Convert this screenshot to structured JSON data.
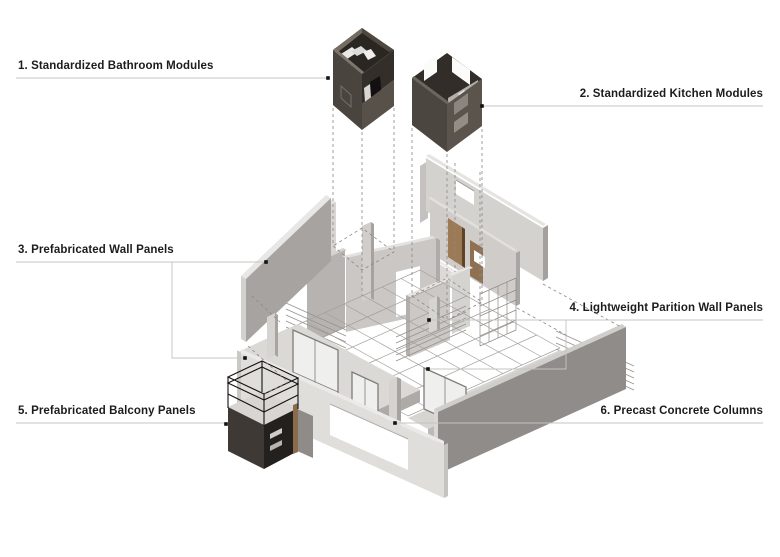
{
  "page": {
    "width": 780,
    "height": 557,
    "background": "#ffffff"
  },
  "diagram": {
    "kind": "exploded axonometric assembly diagram",
    "subject": "prefabricated modular housing components"
  },
  "labels": [
    {
      "id": "1",
      "text": "1. Standardized Bathroom Modules",
      "side": "left",
      "x": 18,
      "y": 60,
      "leader": {
        "lines": [
          [
            [
              16,
              78
            ],
            [
              328,
              78
            ]
          ]
        ],
        "dots": [
          [
            328,
            78
          ]
        ]
      }
    },
    {
      "id": "2",
      "text": "2. Standardized Kitchen Modules",
      "side": "right",
      "right": 17,
      "y": 88,
      "leader": {
        "lines": [
          [
            [
              482,
              106
            ],
            [
              763,
              106
            ]
          ]
        ],
        "dots": [
          [
            482,
            106
          ]
        ]
      }
    },
    {
      "id": "3",
      "text": "3. Prefabricated Wall Panels",
      "side": "left",
      "x": 18,
      "y": 244,
      "leader": {
        "lines": [
          [
            [
              16,
              262
            ],
            [
              266,
              262
            ]
          ],
          [
            [
              172,
              262
            ],
            [
              172,
              358
            ],
            [
              245,
              358
            ]
          ]
        ],
        "dots": [
          [
            266,
            262
          ],
          [
            245,
            358
          ]
        ]
      }
    },
    {
      "id": "4",
      "text": "4. Lightweight Parition Wall Panels",
      "side": "right",
      "right": 17,
      "y": 302,
      "leader": {
        "lines": [
          [
            [
              429,
              320
            ],
            [
              763,
              320
            ]
          ],
          [
            [
              566,
              320
            ],
            [
              566,
              369
            ],
            [
              428,
              369
            ]
          ]
        ],
        "dots": [
          [
            429,
            320
          ],
          [
            428,
            369
          ]
        ]
      }
    },
    {
      "id": "5",
      "text": "5. Prefabricated Balcony Panels",
      "side": "left",
      "x": 18,
      "y": 405,
      "leader": {
        "lines": [
          [
            [
              16,
              423
            ],
            [
              226,
              423
            ]
          ]
        ],
        "dots": [
          [
            226,
            424
          ]
        ]
      }
    },
    {
      "id": "6",
      "text": "6. Precast Concrete Columns",
      "side": "right",
      "right": 17,
      "y": 405,
      "leader": {
        "lines": [
          [
            [
              395,
              423
            ],
            [
              763,
              423
            ]
          ]
        ],
        "dots": [
          [
            395,
            423
          ]
        ]
      }
    }
  ],
  "palette": {
    "label_color": "#1c1c1c",
    "leader_color": "#c6c4c1",
    "dot_color": "#111111",
    "panel_light": "#d5d3d0",
    "panel_shadow": "#8f8c89",
    "module_dark": "#4c4640",
    "wood_door": "#9b7a55",
    "wireframe": "#96938f"
  }
}
